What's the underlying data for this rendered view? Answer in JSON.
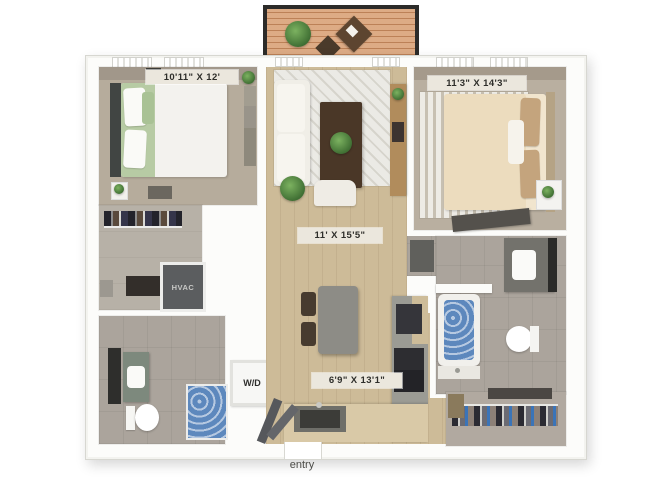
{
  "plan_title": "two-bedroom-floorplan",
  "rooms": {
    "bedroom_left": {
      "dimensions": "10'11\" X 12'"
    },
    "bedroom_right": {
      "dimensions": "11'3\" X 14'3\""
    },
    "living_room": {
      "dimensions": "11' X 15'5\""
    },
    "kitchen": {
      "dimensions": "6'9\" X 13'1\""
    }
  },
  "utilities": {
    "washer_dryer": "W/D",
    "hvac": "HVAC"
  },
  "entry": {
    "label": "entry"
  },
  "colors": {
    "wall": "#fcfcfa",
    "wood_floor": "#cdbb98",
    "carpet": "#b6ac9c",
    "bath_tile": "#aba49c",
    "accent_wall": "#a1978a",
    "water_blue": "#5d88bd",
    "deck_wood": "#d2966b",
    "railing_black": "#2c2b29",
    "label_bg": "#ebe7dd",
    "green_bedding": "#b7cba4",
    "tan_bedding": "#ecdcbe"
  }
}
